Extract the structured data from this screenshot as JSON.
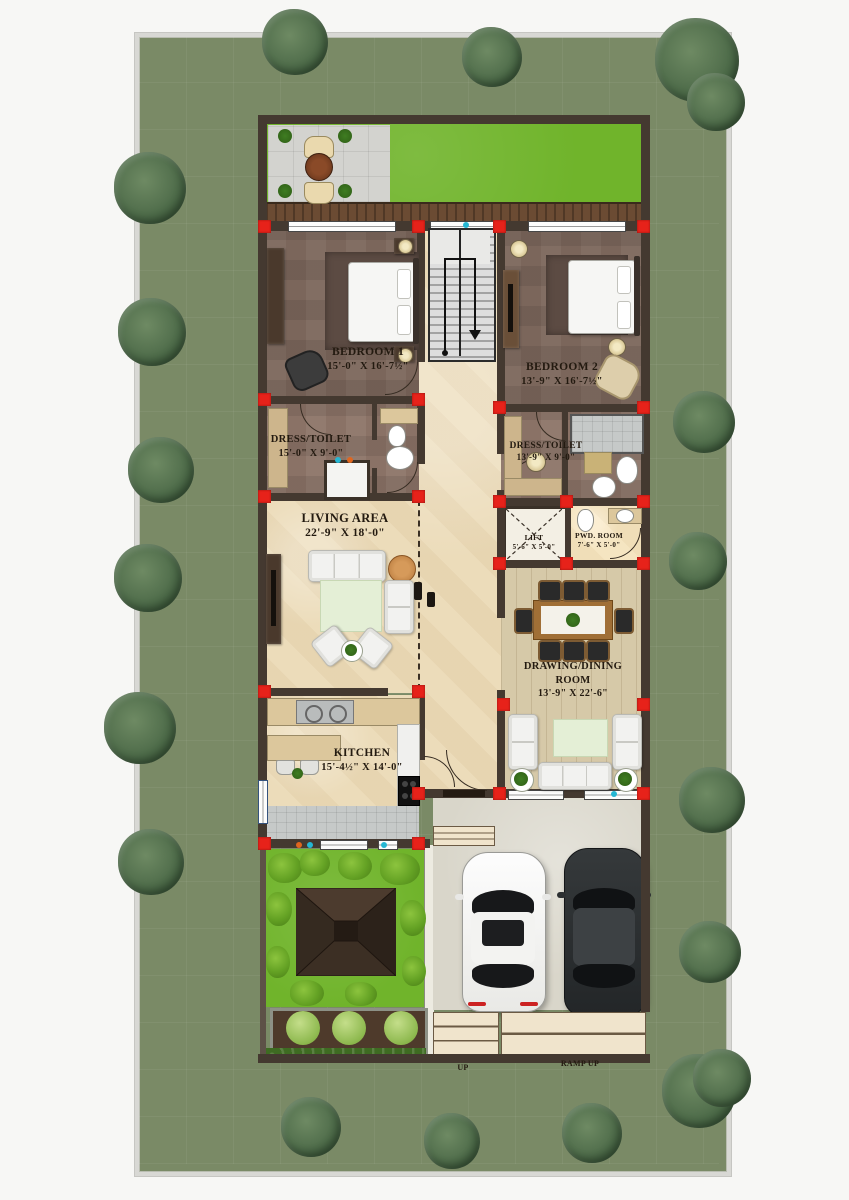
{
  "plan_title": "Ground floor residential plan",
  "rooms": {
    "bedroom1": {
      "name": "BEDROOM 1",
      "dims": "15'-0\" X 16'-7½\""
    },
    "bedroom2": {
      "name": "BEDROOM 2",
      "dims": "13'-9\" X 16'-7½\""
    },
    "dress1": {
      "name": "DRESS/TOILET",
      "dims": "15'-0\" X 9'-0\""
    },
    "dress2": {
      "name": "DRESS/TOILET",
      "dims": "13'-9\" X 9'-0\""
    },
    "living": {
      "name": "LIVING AREA",
      "dims": "22'-9\" X 18'-0\""
    },
    "lift": {
      "name": "LIFT",
      "dims": "5'-6\" X 5'-0\""
    },
    "pwd": {
      "name": "PWD. ROOM",
      "dims": "7'-6\" X 5'-0\""
    },
    "dining": {
      "line1": "DRAWING/DINING",
      "line2": "ROOM",
      "dims": "13'-9\" X 22'-6\""
    },
    "kitchen": {
      "name": "KITCHEN",
      "dims": "15'-4½\" X 14'-0\""
    }
  },
  "annotations": {
    "up": "UP",
    "ramp_up": "RAMP UP"
  },
  "colors": {
    "plot_green": "#7a8a66",
    "lawn_green": "#70b42b",
    "wall_brown": "#443930",
    "marble": "#ecdcba",
    "column_red": "#e7221a",
    "tree_green": "#41603f"
  }
}
